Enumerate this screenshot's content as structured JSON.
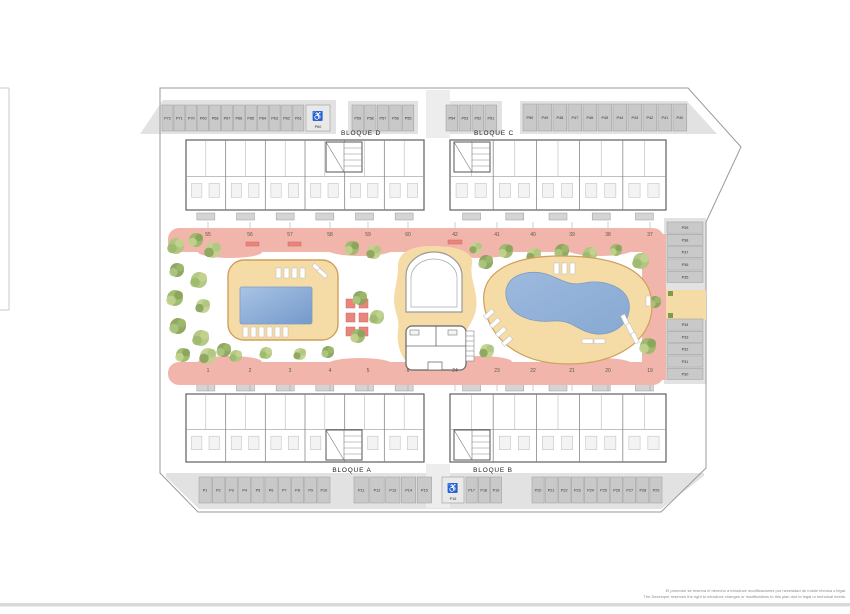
{
  "blocks": {
    "a": "BLOQUE A",
    "b": "BLOQUE B",
    "c": "BLOQUE C",
    "d": "BLOQUE D"
  },
  "parking": {
    "top_left": [
      "P72",
      "P71",
      "P70",
      "P69",
      "P68",
      "P67",
      "P66",
      "P65",
      "P64",
      "P63",
      "P62",
      "P61"
    ],
    "top_left_accessible": "P60",
    "top_mid_left": [
      "P59",
      "P58",
      "P57",
      "P56",
      "P55"
    ],
    "top_mid_right": [
      "P54",
      "P53",
      "P52",
      "P51"
    ],
    "top_right": [
      "P50",
      "P49",
      "P48",
      "P47",
      "P46",
      "P45",
      "P44",
      "P43",
      "P42",
      "P41",
      "P40"
    ],
    "right_column_upper": [
      "P39",
      "P38",
      "P37",
      "P36",
      "P35"
    ],
    "right_column_lower": [
      "P34",
      "P33",
      "P32",
      "P31",
      "P30"
    ],
    "bottom_left": [
      "P1",
      "P2",
      "P3",
      "P4",
      "P5",
      "P6",
      "P7",
      "P8",
      "P9",
      "P10"
    ],
    "bottom_mid_left": [
      "P11",
      "P12",
      "P13",
      "P14",
      "P15"
    ],
    "bottom_accessible": "P16",
    "bottom_mid_right": [
      "P17",
      "P18",
      "P19"
    ],
    "bottom_right": [
      "P20",
      "P21",
      "P22",
      "P23",
      "P24",
      "P25",
      "P26",
      "P27",
      "P28",
      "P29"
    ]
  },
  "unit_numbers": {
    "top_left": [
      "55",
      "56",
      "57",
      "58",
      "59",
      "60"
    ],
    "top_right": [
      "42",
      "41",
      "40",
      "39",
      "38",
      "37"
    ],
    "bottom_left": [
      "1",
      "2",
      "3",
      "4",
      "5",
      "6"
    ],
    "bottom_right": [
      "24",
      "23",
      "22",
      "21",
      "20",
      "19"
    ]
  },
  "accessible_icon": "♿",
  "disclaimer": {
    "es": "El promotor se reserva el derecho a introducir modificaciones por necesidad de índole técnica o legal.",
    "en": "The Developer reserves the right to introduce changes or modifications to this plan due to legal or technical needs."
  },
  "colors": {
    "walkway": "#f2b5ac",
    "deck": "#f5dba6",
    "deck_edge": "#cfa05c",
    "pool_light": "#a9c4e4",
    "pool_dark": "#7499cb",
    "parking_cell": "#c9c9c9",
    "parking_strip": "#e2e2e2",
    "accent_red": "#e8857c",
    "tree_greens": [
      "#aec77f",
      "#9cb96a",
      "#c3d18f",
      "#8aa35b"
    ]
  }
}
